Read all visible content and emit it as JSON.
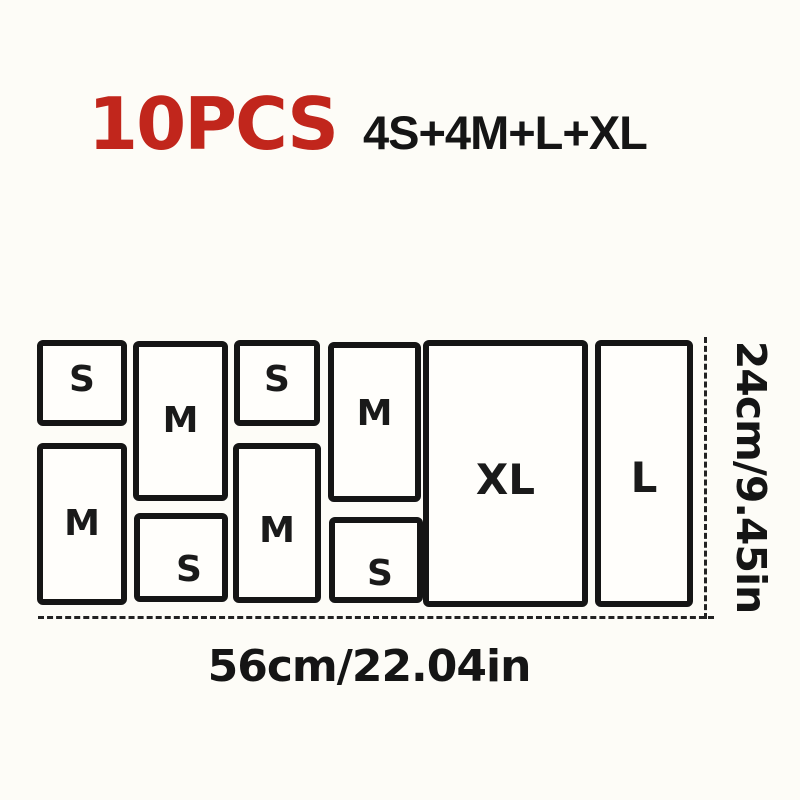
{
  "header": {
    "pieces_count": "10PCS",
    "composition": "4S+4M+L+XL"
  },
  "diagram": {
    "boxes": [
      {
        "label": "S"
      },
      {
        "label": "M"
      },
      {
        "label": "S"
      },
      {
        "label": "M"
      },
      {
        "label": "M"
      },
      {
        "label": "S"
      },
      {
        "label": "M"
      },
      {
        "label": "S"
      },
      {
        "label": "XL"
      },
      {
        "label": "L"
      }
    ],
    "width_label": "56cm/22.04in",
    "height_label": "24cm/9.45in"
  },
  "colors": {
    "accent_red": "#c1261c",
    "ink": "#151515",
    "background": "#fdfcf7"
  }
}
